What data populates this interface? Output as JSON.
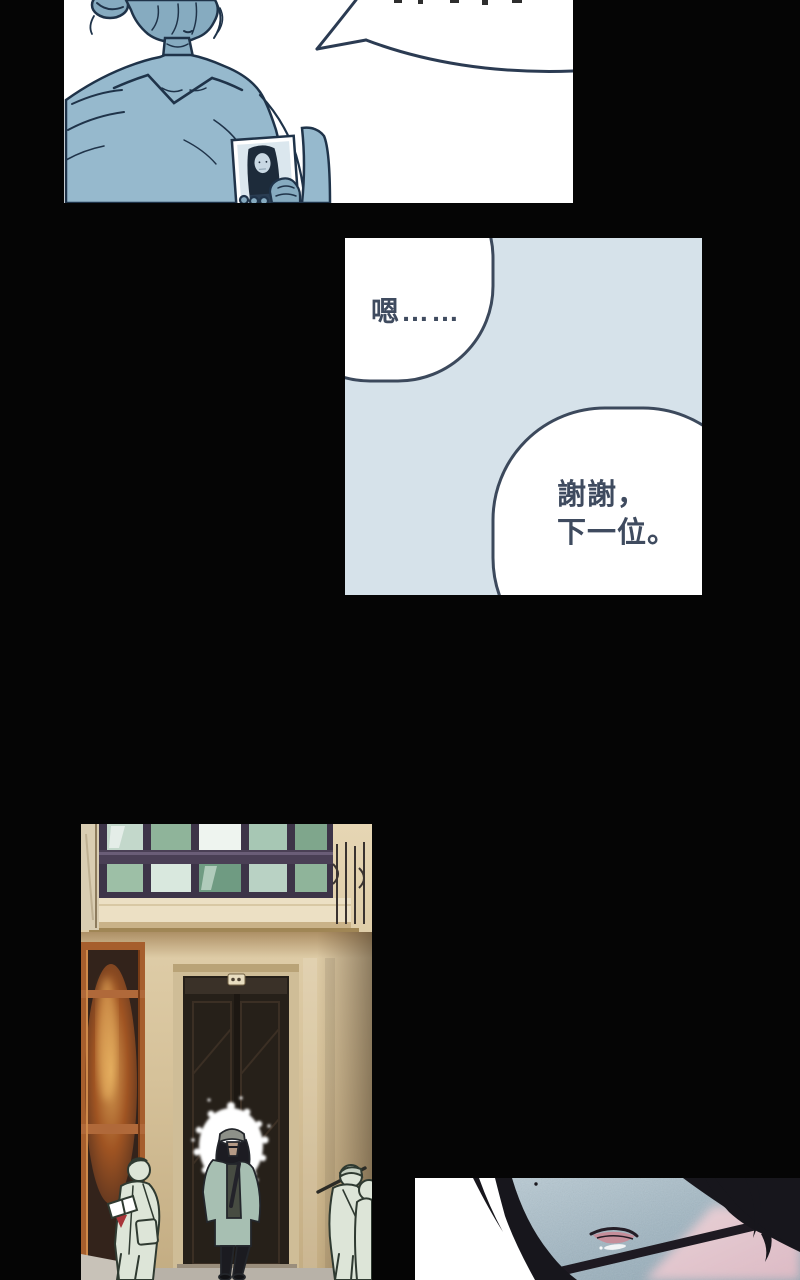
{
  "page": {
    "background": "#050505",
    "width": 800,
    "height": 1280
  },
  "top_panel": {
    "background": "#ffffff",
    "outline_color": "#1f3349",
    "skin_color": "#86abc0",
    "sweater_color": "#96b9cd",
    "photo_bg_color": "#dbe7ee",
    "photo_hair_color": "#1d2b3a",
    "speech_bubble_text_fragment": ""
  },
  "middle_panel": {
    "background": "#d6e2ea",
    "bubble_fill": "#ffffff",
    "bubble_stroke": "#3c495c",
    "text_color": "#3f4b5f",
    "bubble1_text": "嗯……",
    "bubble2_line1": "謝謝，",
    "bubble2_line2": "下一位。"
  },
  "street_panel": {
    "wall_color": "#d8c5a0",
    "window_frame_color": "#3d3448",
    "glass_color": "#9dbfa6",
    "ledge_color": "#ece0c4",
    "shop_frame_color": "#b0693a",
    "door_color": "#262019",
    "halo_color": "#ffffff",
    "cap_color": "#8d9089",
    "jacket_color": "#a7bfb2",
    "pants_color": "#1b1b20",
    "sketch_people_color": "#dde5d8",
    "sketch_outline_color": "#2f3a31",
    "fire_glow_color": "#e8a04f"
  },
  "closeup_panel": {
    "background": "#ffffff",
    "skin_color": "#a9bec9",
    "hair_color": "#17161c",
    "lip_color": "#c58e9a",
    "lip_outline_color": "#241d26",
    "blush_color": "#ecc9d0"
  }
}
